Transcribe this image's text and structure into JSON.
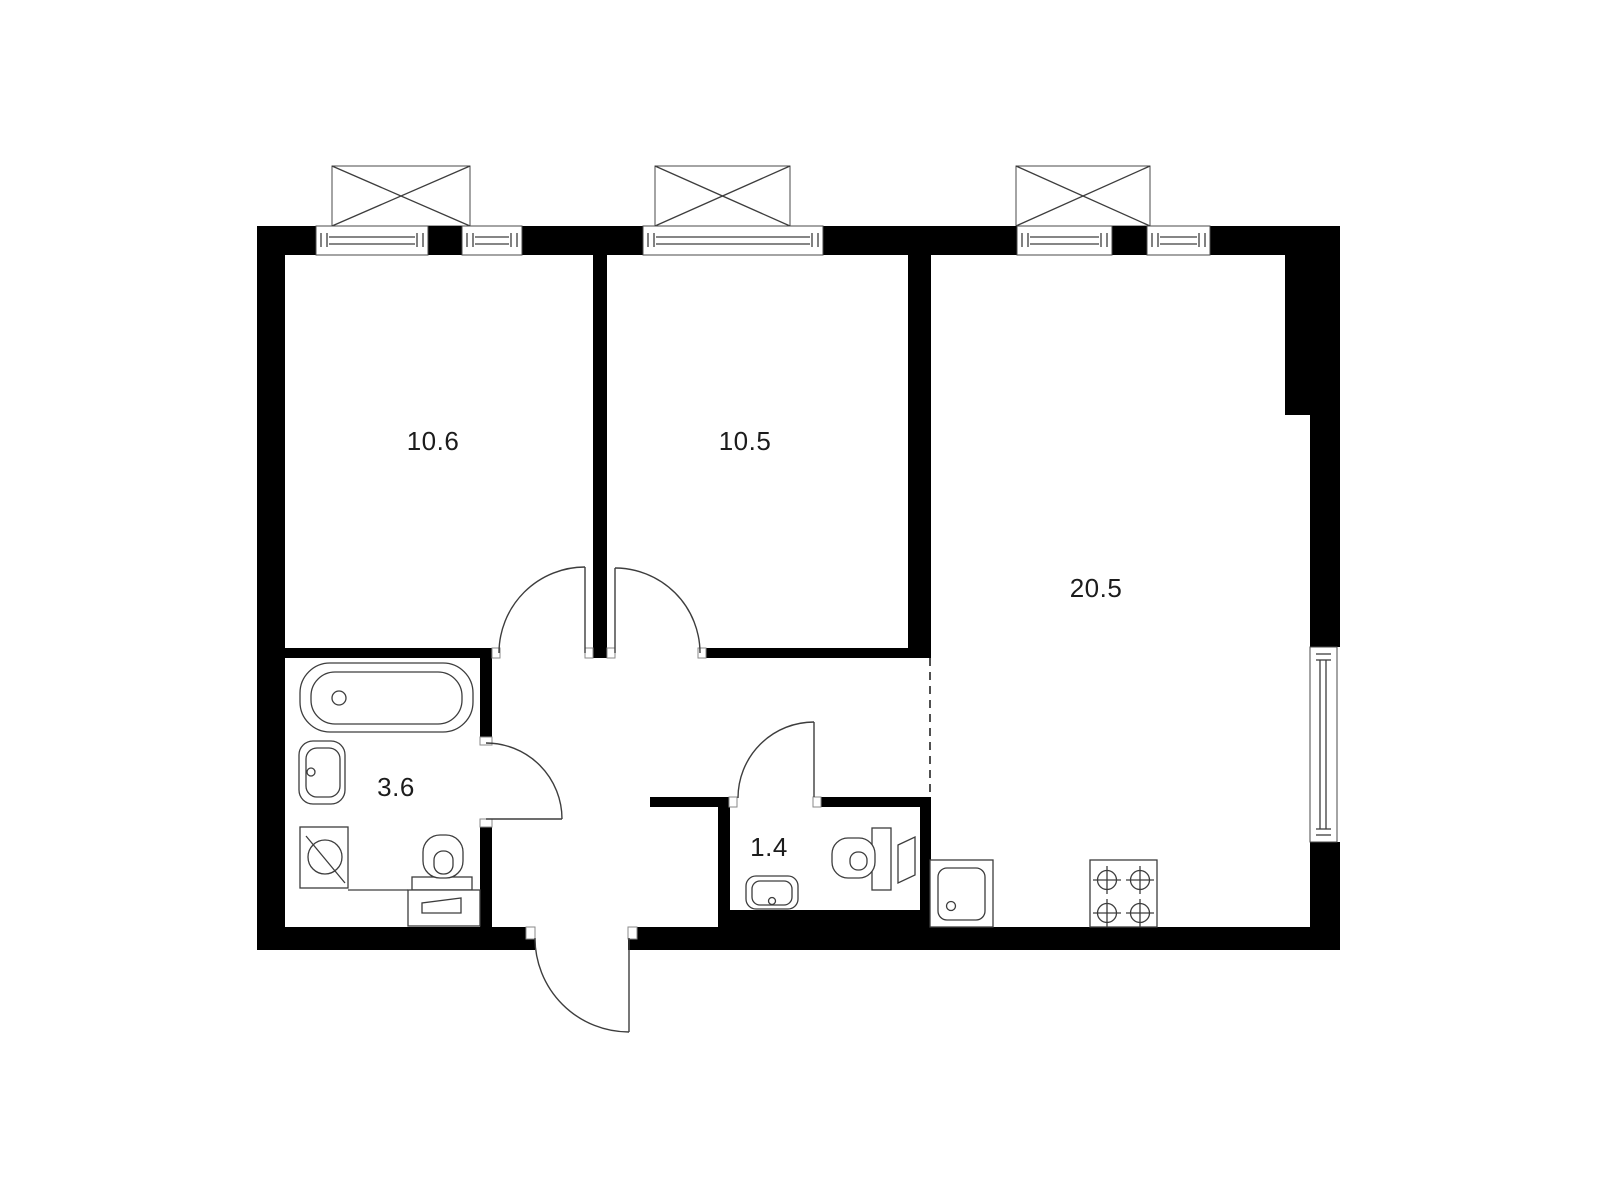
{
  "plan": {
    "colors": {
      "background": "#ffffff",
      "wall": "#000000",
      "line": "#3d3d3d",
      "label": "#1c1c1c"
    },
    "rooms": [
      {
        "key": "bedroom-1",
        "area": "10.6"
      },
      {
        "key": "bedroom-2",
        "area": "10.5"
      },
      {
        "key": "living-kitchen",
        "area": "20.5"
      },
      {
        "key": "bathroom",
        "area": "3.6"
      },
      {
        "key": "toilet",
        "area": "1.4"
      }
    ]
  }
}
